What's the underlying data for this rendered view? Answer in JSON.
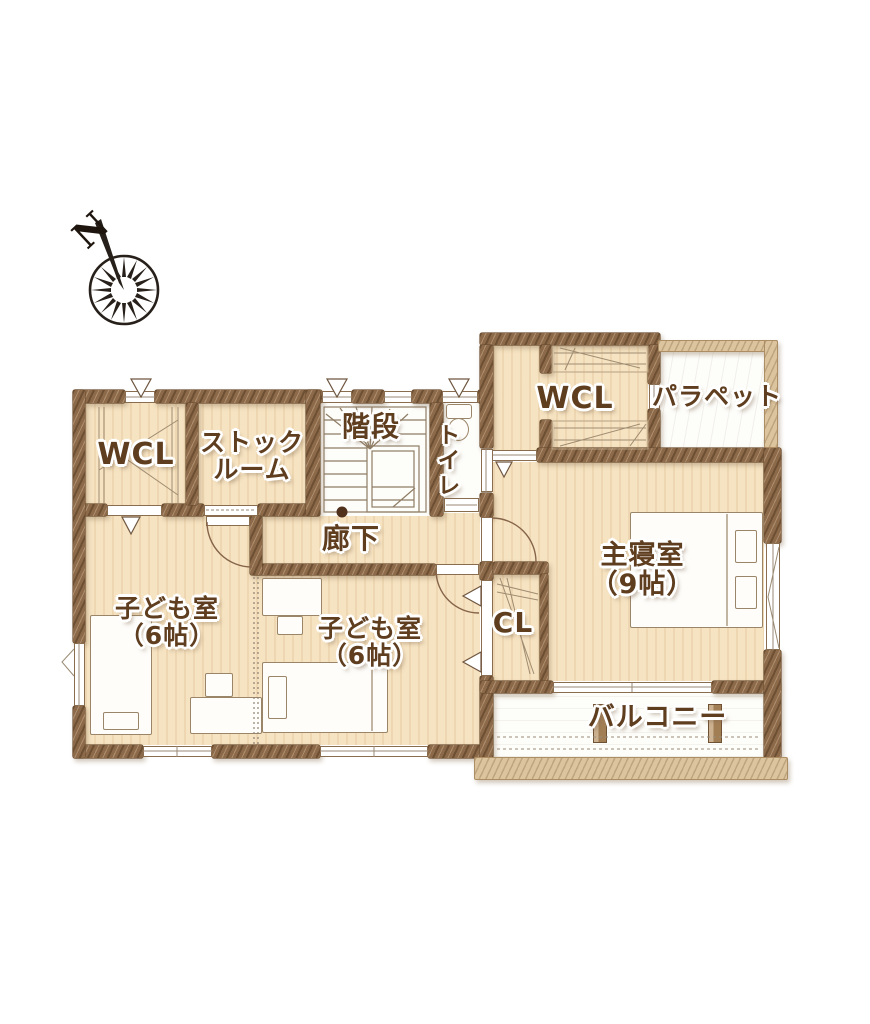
{
  "compass": {
    "north_label": "N"
  },
  "rooms": {
    "wcl_left": {
      "name": "WCL"
    },
    "stock_room": {
      "name_line1": "ストック",
      "name_line2": "ルーム"
    },
    "stairs": {
      "name": "階段"
    },
    "toilet": {
      "name": "トイレ"
    },
    "hallway": {
      "name": "廊下"
    },
    "child_room_west": {
      "name": "子ども室",
      "size": "（6帖）"
    },
    "child_room_center": {
      "name": "子ども室",
      "size": "（6帖）"
    },
    "closet_cl": {
      "name": "CL"
    },
    "wcl_right": {
      "name": "WCL"
    },
    "parapet": {
      "name": "パラペット"
    },
    "master_bedroom": {
      "name": "主寝室",
      "size": "（9帖）"
    },
    "balcony": {
      "name": "バルコニー"
    }
  },
  "colors": {
    "wall_brown": "#8c6a49",
    "wall_light": "#dcc59e",
    "room_tan": "#f6e3c1",
    "room_white": "#fdfdfa",
    "label_brown": "#5f3d1f",
    "line_brown": "#86644a",
    "compass_black": "#27201a"
  }
}
